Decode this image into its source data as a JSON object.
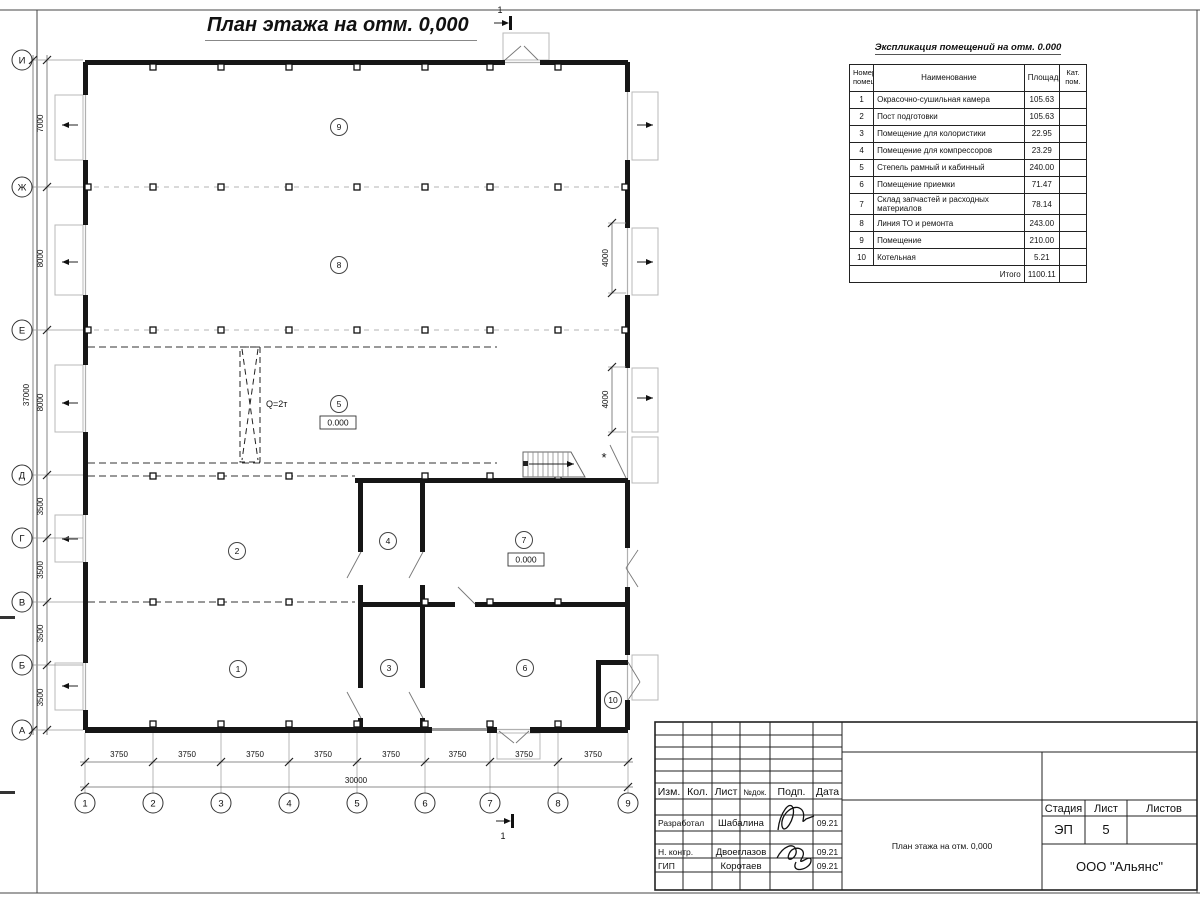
{
  "sheet": {
    "plan_title": "План этажа на отм. 0,000",
    "section_mark": "1"
  },
  "plan": {
    "grid": {
      "row_labels": [
        "И",
        "Ж",
        "Е",
        "Д",
        "Г",
        "В",
        "Б",
        "А"
      ],
      "col_labels": [
        "1",
        "2",
        "3",
        "4",
        "5",
        "6",
        "7",
        "8",
        "9"
      ],
      "row_dims": [
        "7000",
        "8000",
        "8000",
        "3500",
        "3500",
        "3500",
        "3500"
      ],
      "col_dims": [
        "3750",
        "3750",
        "3750",
        "3750",
        "3750",
        "3750",
        "3750",
        "3750"
      ],
      "row_total": "37000",
      "col_total": "30000",
      "right_dims": [
        "4000",
        "4000"
      ]
    },
    "rooms": [
      "9",
      "8",
      "5",
      "2",
      "4",
      "7",
      "1",
      "3",
      "6",
      "10"
    ],
    "crane_label": "Q=2т",
    "elevations": [
      "0.000",
      "0.000"
    ],
    "asterisk": "*"
  },
  "explication": {
    "title": "Экспликация помещений на отм. 0.000",
    "headers": {
      "num": "Номер помещ.",
      "name": "Наименование",
      "area": "Площадь",
      "cat": "Кат. пом."
    },
    "rows": [
      [
        "1",
        "Окрасочно-сушильная камера",
        "105.63"
      ],
      [
        "2",
        "Пост подготовки",
        "105.63"
      ],
      [
        "3",
        "Помещение для колористики",
        "22.95"
      ],
      [
        "4",
        "Помещение для компрессоров",
        "23.29"
      ],
      [
        "5",
        "Степель рамный и кабинный",
        "240.00"
      ],
      [
        "6",
        "Помещение приемки",
        "71.47"
      ],
      [
        "7",
        "Склад запчастей и расходных материалов",
        "78.14"
      ],
      [
        "8",
        "Линия ТО и ремонта",
        "243.00"
      ],
      [
        "9",
        "Помещение",
        "210.00"
      ],
      [
        "10",
        "Котельная",
        "5.21"
      ]
    ],
    "total_label": "Итого",
    "total_value": "1100.11"
  },
  "title_block": {
    "header_cols": [
      "Изм.",
      "Кол.",
      "Лист",
      "№док.",
      "Подп.",
      "Дата"
    ],
    "people": [
      {
        "role": "Разработал",
        "name": "Шабалина",
        "date": "09.21"
      },
      {
        "role": "Н. контр.",
        "name": "Двоеглазов",
        "date": "09.21"
      },
      {
        "role": "ГИП",
        "name": "Коротаев",
        "date": "09.21"
      }
    ],
    "stage_label": "Стадия",
    "sheet_label": "Лист",
    "sheets_label": "Листов",
    "stage": "ЭП",
    "sheet_no": "5",
    "doc_name": "План этажа на отм. 0,000",
    "company": "ООО \"Альянс\""
  }
}
